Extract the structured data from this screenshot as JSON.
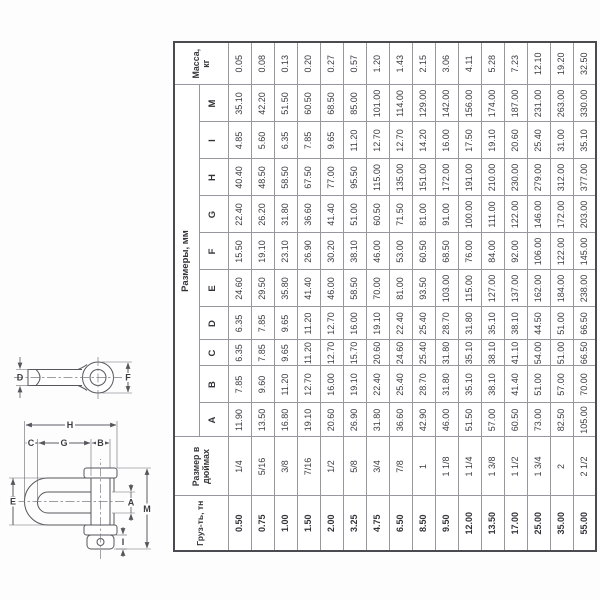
{
  "colors": {
    "text": "#3a3a40",
    "grid": "#97979d",
    "outer_border": "#4a4a50",
    "drawing": "#56565c",
    "background": "#ffffff"
  },
  "diagram": {
    "labels": {
      "d": "D",
      "f": "F",
      "e": "E",
      "c": "C",
      "g": "G",
      "b": "B",
      "h": "H",
      "a": "A",
      "m": "M",
      "i": "I"
    }
  },
  "table": {
    "header": {
      "load": "Груз-ть, тн",
      "size_line1": "Размер в",
      "size_line2": "дюймах",
      "dims_group": "Размеры, мм",
      "dim_letters": [
        "A",
        "B",
        "C",
        "D",
        "E",
        "F",
        "G",
        "H",
        "I",
        "M"
      ],
      "mass_line1": "Масса,",
      "mass_line2": "кг"
    },
    "rows": [
      {
        "load": "0.50",
        "size": "1/4",
        "dims": [
          "11.90",
          "7.85",
          "6.35",
          "6.35",
          "24.60",
          "15.50",
          "22.40",
          "40.40",
          "4.85",
          "35.10"
        ],
        "mass": "0.05"
      },
      {
        "load": "0.75",
        "size": "5/16",
        "dims": [
          "13.50",
          "9.60",
          "7.85",
          "7.85",
          "29.50",
          "19.10",
          "26.20",
          "48.50",
          "5.60",
          "42.20"
        ],
        "mass": "0.08"
      },
      {
        "load": "1.00",
        "size": "3/8",
        "dims": [
          "16.80",
          "11.20",
          "9.65",
          "9.65",
          "35.80",
          "23.10",
          "31.80",
          "58.50",
          "6.35",
          "51.50"
        ],
        "mass": "0.13"
      },
      {
        "load": "1.50",
        "size": "7/16",
        "dims": [
          "19.10",
          "12.70",
          "11.20",
          "11.20",
          "41.40",
          "26.90",
          "36.60",
          "67.50",
          "7.85",
          "60.50"
        ],
        "mass": "0.20"
      },
      {
        "load": "2.00",
        "size": "1/2",
        "dims": [
          "20.60",
          "16.00",
          "12.70",
          "12.70",
          "46.00",
          "30.20",
          "41.40",
          "77.00",
          "9.65",
          "68.50"
        ],
        "mass": "0.27"
      },
      {
        "load": "3.25",
        "size": "5/8",
        "dims": [
          "26.90",
          "19.10",
          "15.70",
          "16.00",
          "58.50",
          "38.10",
          "51.00",
          "95.50",
          "11.20",
          "85.00"
        ],
        "mass": "0.57"
      },
      {
        "load": "4.75",
        "size": "3/4",
        "dims": [
          "31.80",
          "22.40",
          "20.60",
          "19.10",
          "70.00",
          "46.00",
          "60.50",
          "115.00",
          "12.70",
          "101.00"
        ],
        "mass": "1.20"
      },
      {
        "load": "6.50",
        "size": "7/8",
        "dims": [
          "36.60",
          "25.40",
          "24.60",
          "22.40",
          "81.00",
          "53.00",
          "71.50",
          "135.00",
          "12.70",
          "114.00"
        ],
        "mass": "1.43"
      },
      {
        "load": "8.50",
        "size": "1",
        "dims": [
          "42.90",
          "28.70",
          "25.40",
          "25.40",
          "93.50",
          "60.50",
          "81.00",
          "151.00",
          "14.20",
          "129.00"
        ],
        "mass": "2.15"
      },
      {
        "load": "9.50",
        "size": "1 1/8",
        "dims": [
          "46.00",
          "31.80",
          "31.80",
          "28.70",
          "103.00",
          "68.50",
          "91.00",
          "172.00",
          "16.00",
          "142.00"
        ],
        "mass": "3.06"
      },
      {
        "load": "12.00",
        "size": "1 1/4",
        "dims": [
          "51.50",
          "35.10",
          "35.10",
          "31.80",
          "115.00",
          "76.00",
          "100.00",
          "191.00",
          "17.50",
          "156.00"
        ],
        "mass": "4.11"
      },
      {
        "load": "13.50",
        "size": "1 3/8",
        "dims": [
          "57.00",
          "38.10",
          "38.10",
          "35.10",
          "127.00",
          "84.00",
          "111.00",
          "210.00",
          "19.10",
          "174.00"
        ],
        "mass": "5.28"
      },
      {
        "load": "17.00",
        "size": "1 1/2",
        "dims": [
          "60.50",
          "41.40",
          "41.10",
          "38.10",
          "137.00",
          "92.00",
          "122.00",
          "230.00",
          "20.60",
          "187.00"
        ],
        "mass": "7.23"
      },
      {
        "load": "25.00",
        "size": "1 3/4",
        "dims": [
          "73.00",
          "51.00",
          "54.00",
          "44.50",
          "162.00",
          "106.00",
          "146.00",
          "279.00",
          "25.40",
          "231.00"
        ],
        "mass": "12.10"
      },
      {
        "load": "35.00",
        "size": "2",
        "dims": [
          "82.50",
          "57.00",
          "51.00",
          "51.00",
          "184.00",
          "122.00",
          "172.00",
          "312.00",
          "31.00",
          "263.00"
        ],
        "mass": "19.20"
      },
      {
        "load": "55.00",
        "size": "2 1/2",
        "dims": [
          "105.00",
          "70.00",
          "66.50",
          "66.50",
          "238.00",
          "145.00",
          "203.00",
          "377.00",
          "35.10",
          "330.00"
        ],
        "mass": "32.50"
      }
    ]
  }
}
